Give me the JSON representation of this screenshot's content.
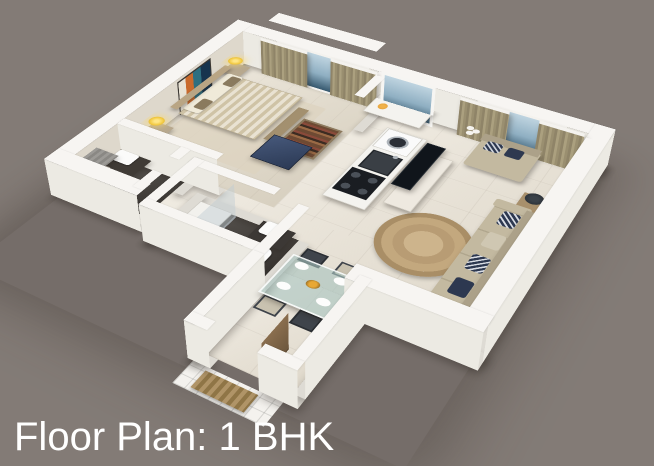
{
  "caption": {
    "text": "Floor Plan: 1 BHK"
  },
  "scene": {
    "type": "isometric-3d-floor-plan-render",
    "rooms": [
      "bedroom",
      "en-suite-bathroom",
      "kitchen",
      "living-room",
      "common-bathroom",
      "dining-area",
      "entry"
    ]
  },
  "colors": {
    "bg": "#837b76",
    "wall": "#f7f5f2",
    "wall_face": "#eceae3",
    "wall_side": "#dedbd4",
    "floor": "#e8e1d3",
    "floor_bed": "#e3dbca",
    "floor_dark": "#45403b",
    "curtain": "#978c6f",
    "glass": "#8fafc2",
    "bed_a": "#cfc3a6",
    "bed_b": "#e9e2d2",
    "pillow": "#f0ead9",
    "sofa": "#c3b9a0",
    "sofa_dark": "#aca189",
    "navy": "#2c3a55",
    "rug": "#c3a87e",
    "wood": "#a8906c",
    "lamp": "#f2c940",
    "tv": "#10151b",
    "steel": "#aeb4ba",
    "door": "#8a6e4e",
    "mat": "#a98b5e",
    "art_teal": "#2e6f80",
    "art_orange": "#c96a2c",
    "text": "#ffffff"
  }
}
